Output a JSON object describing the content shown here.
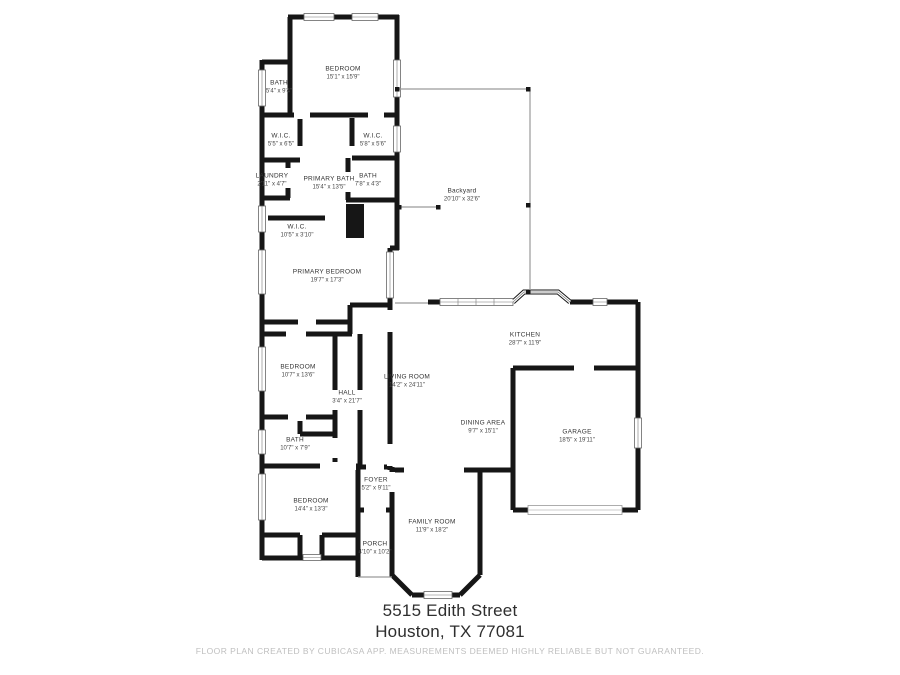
{
  "page": {
    "background": "#ffffff"
  },
  "plan": {
    "wall_color": "#161616",
    "thin_line_color": "#9a9a9a",
    "window_color": "#666666",
    "rooms": [
      {
        "name": "BEDROOM",
        "dims": "15'1\" x 15'9\"",
        "x": 343,
        "y": 74
      },
      {
        "name": "BATH",
        "dims": "5'4\" x 9'4\"",
        "x": 279,
        "y": 88
      },
      {
        "name": "W.I.C.",
        "dims": "5'5\" x 6'5\"",
        "x": 281,
        "y": 141
      },
      {
        "name": "W.I.C.",
        "dims": "5'8\" x 5'6\"",
        "x": 373,
        "y": 141
      },
      {
        "name": "LAUNDRY",
        "dims": "2'11\" x 4'7\"",
        "x": 272,
        "y": 181
      },
      {
        "name": "PRIMARY BATH",
        "dims": "15'4\" x 13'5\"",
        "x": 329,
        "y": 184
      },
      {
        "name": "BATH",
        "dims": "7'8\" x 4'3\"",
        "x": 368,
        "y": 181
      },
      {
        "name": "W.I.C.",
        "dims": "10'5\" x 3'10\"",
        "x": 297,
        "y": 232
      },
      {
        "name": "Backyard",
        "dims": "20'10\" x 32'6\"",
        "x": 462,
        "y": 196
      },
      {
        "name": "PRIMARY BEDROOM",
        "dims": "19'7\" x 17'3\"",
        "x": 327,
        "y": 277
      },
      {
        "name": "BEDROOM",
        "dims": "10'7\" x 13'6\"",
        "x": 298,
        "y": 372
      },
      {
        "name": "HALL",
        "dims": "3'4\" x 21'7\"",
        "x": 347,
        "y": 398
      },
      {
        "name": "LIVING ROOM",
        "dims": "14'2\" x 24'11\"",
        "x": 407,
        "y": 382
      },
      {
        "name": "KITCHEN",
        "dims": "28'7\" x 11'9\"",
        "x": 525,
        "y": 340
      },
      {
        "name": "DINING AREA",
        "dims": "9'7\" x 15'1\"",
        "x": 483,
        "y": 428
      },
      {
        "name": "GARAGE",
        "dims": "18'5\" x 19'11\"",
        "x": 577,
        "y": 437
      },
      {
        "name": "BATH",
        "dims": "10'7\" x 7'9\"",
        "x": 295,
        "y": 445
      },
      {
        "name": "BEDROOM",
        "dims": "14'4\" x 13'3\"",
        "x": 311,
        "y": 506
      },
      {
        "name": "FOYER",
        "dims": "5'2\" x 9'11\"",
        "x": 376,
        "y": 485
      },
      {
        "name": "FAMILY ROOM",
        "dims": "11'9\" x 18'2\"",
        "x": 432,
        "y": 527
      },
      {
        "name": "PORCH",
        "dims": "4'10\" x 10'2\"",
        "x": 375,
        "y": 549
      }
    ]
  },
  "address": {
    "line1": "5515 Edith Street",
    "line2": "Houston, TX 77081"
  },
  "footer": {
    "disclaimer": "FLOOR PLAN CREATED BY CUBICASA APP. MEASUREMENTS DEEMED HIGHLY RELIABLE BUT NOT GUARANTEED."
  }
}
